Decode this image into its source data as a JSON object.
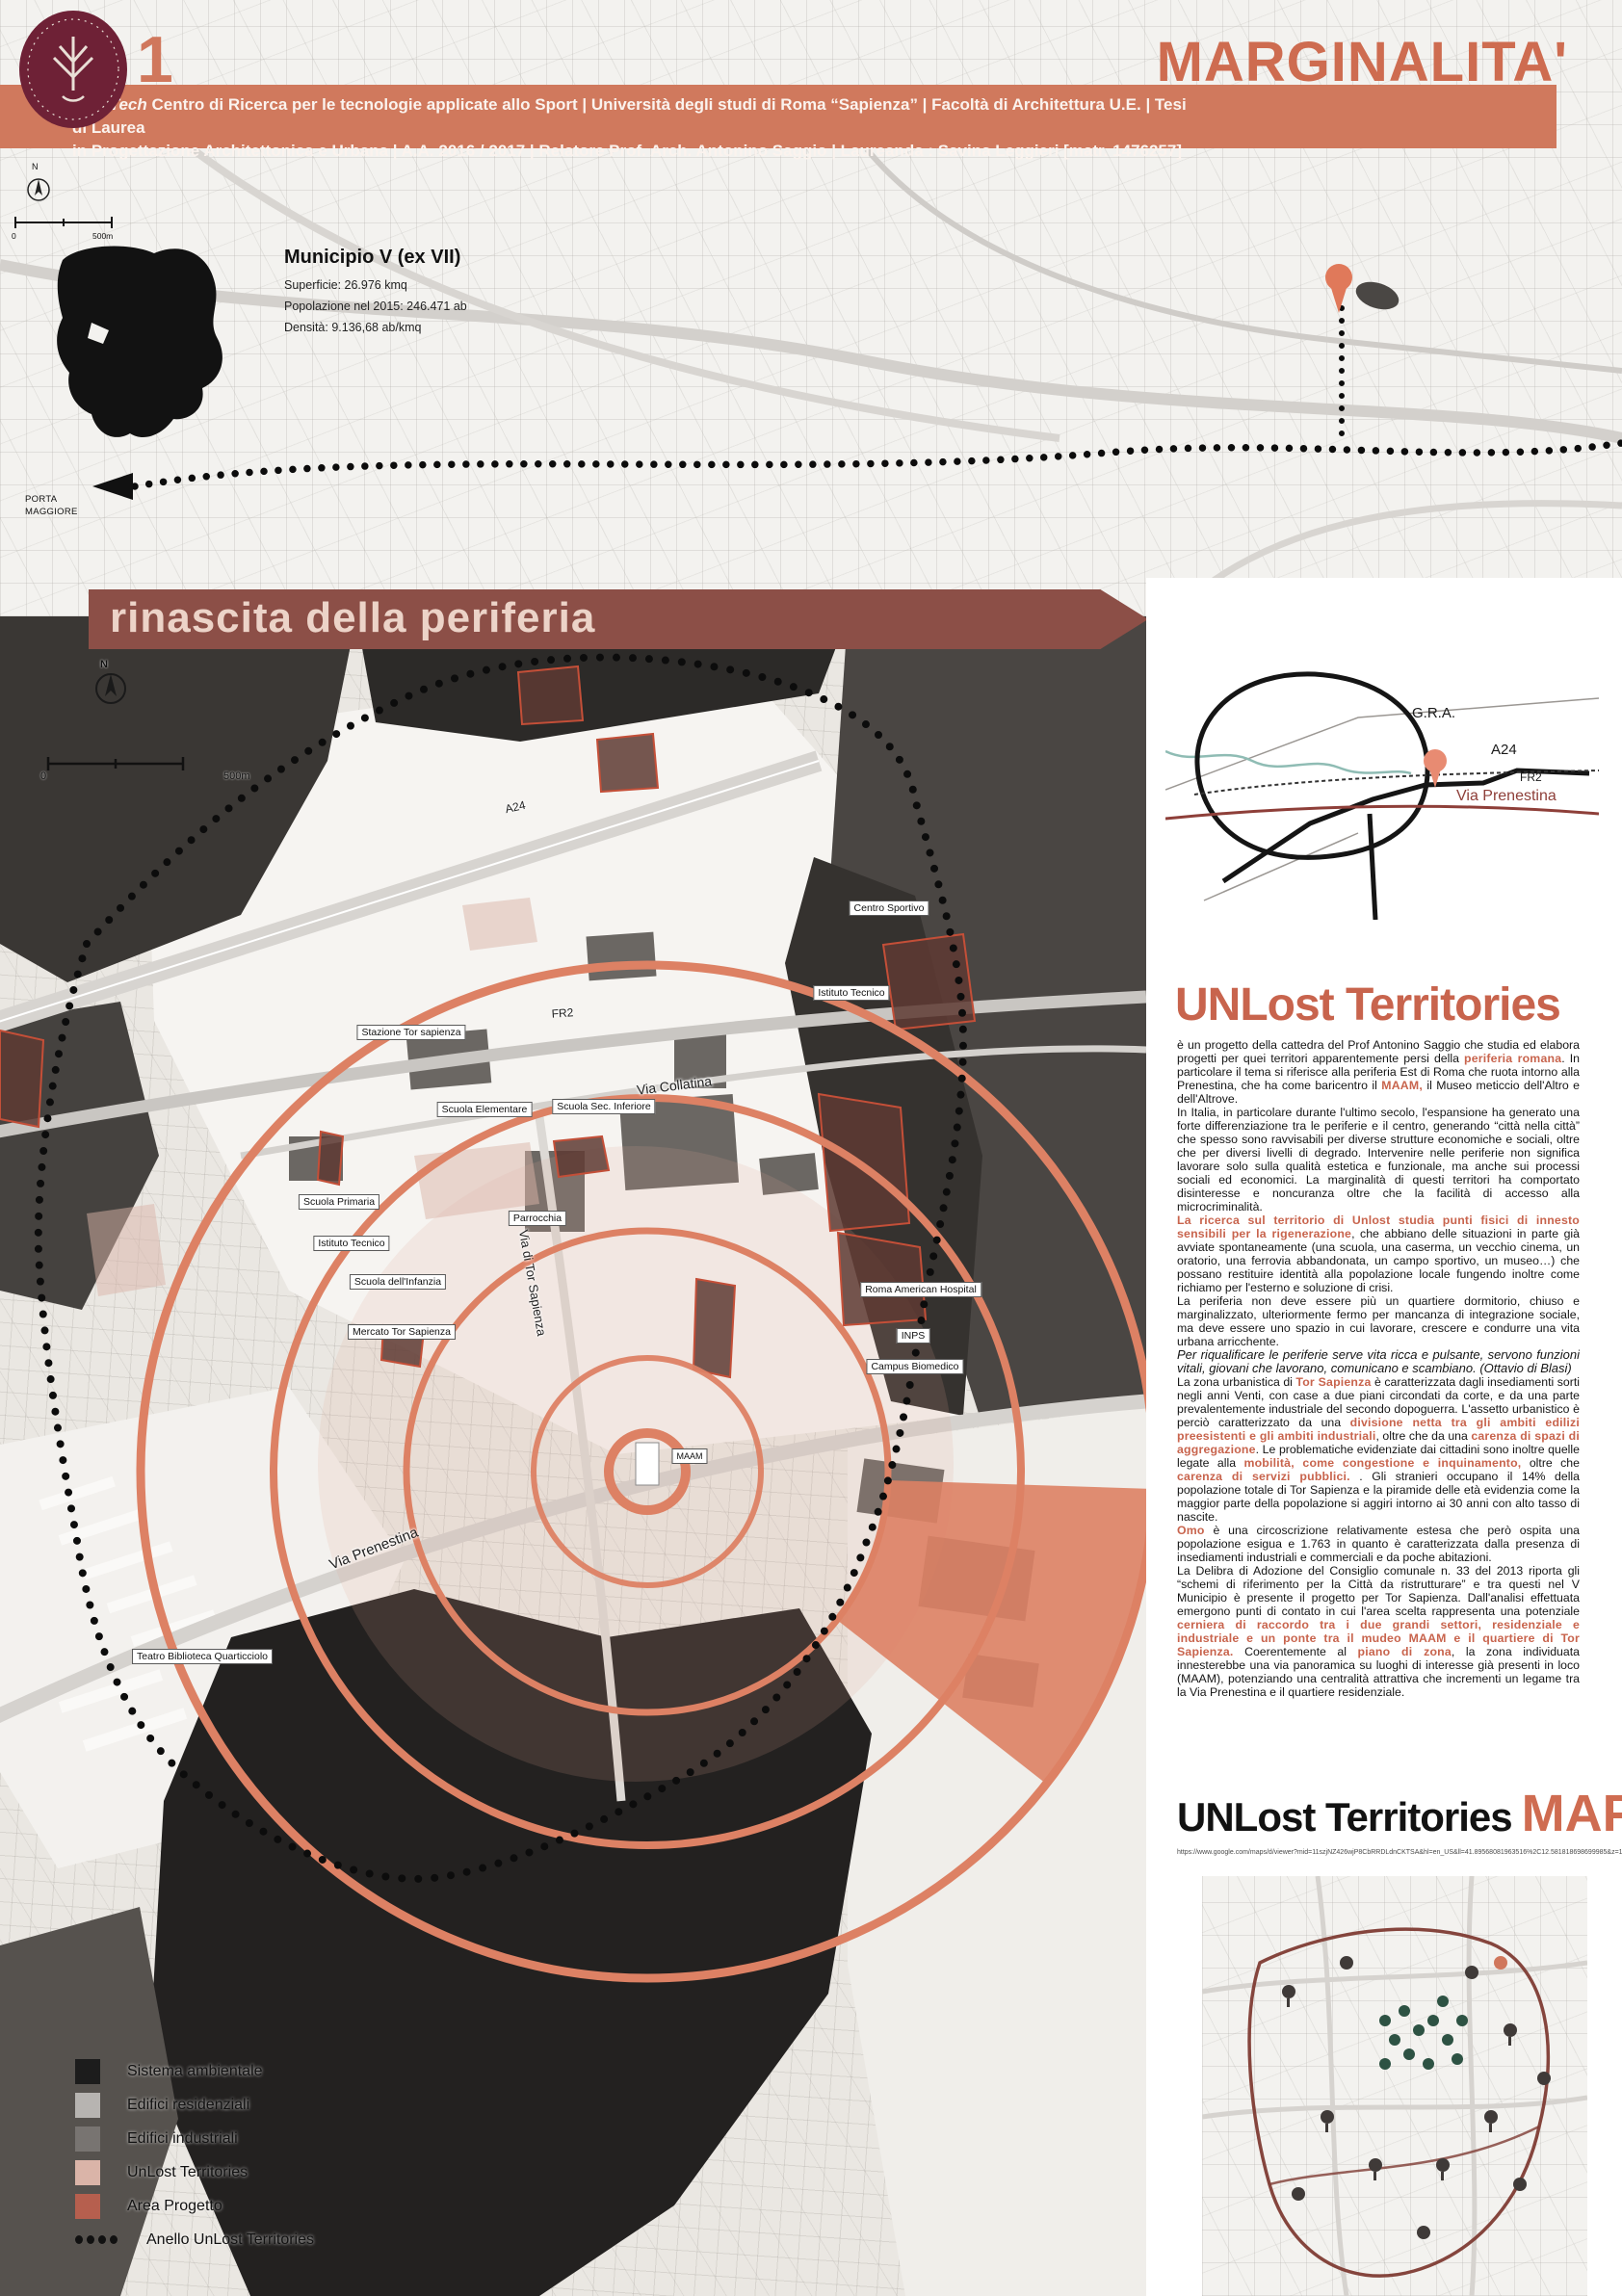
{
  "header": {
    "page_number": "1",
    "logo_name": "sapienza-university-emblem",
    "title": "MARGINALITA'",
    "subtitle_brand": "SporTech",
    "subtitle_line1_rest": " Centro di Ricerca per le tecnologie applicate allo Sport | Università degli studi di Roma “Sapienza” | Facoltà di Architettura U.E. | Tesi di Laurea",
    "subtitle_line2": "in Progettazione Architettonica e Urbana | A.A. 2016 / 2017 | Relatore Prof. Arch. Antonino Saggio | Laureanda : Savina Leggieri [matr. 1476257]"
  },
  "upper_map": {
    "municipio": {
      "title": "Municipio V (ex VII)",
      "stat1": "Superficie: 26.976 kmq",
      "stat2": "Popolazione nel 2015: 246.471 ab",
      "stat3": "Densità: 9.136,68 ab/kmq"
    },
    "porta_maggiore": "PORTA MAGGIORE",
    "north": "N",
    "scale_zero": "0",
    "scale_label": "500m"
  },
  "banner": {
    "text": "rinascita della periferia"
  },
  "main_map": {
    "north": "N",
    "scale_zero": "0",
    "scale_label": "500m",
    "labels_boxed": [
      "Centro Sportivo",
      "Istituto Tecnico",
      "Stazione Tor sapienza",
      "Scuola Elementare",
      "Scuola Sec. Inferiore",
      "Scuola Primaria",
      "Parrocchia",
      "Istituto Tecnico",
      "Scuola dell'Infanzia",
      "Mercato Tor Sapienza",
      "Roma American Hospital",
      "INPS",
      "Campus Biomedico",
      "MAAM",
      "Teatro Biblioteca Quarticciolo"
    ],
    "labels_road": [
      "A24",
      "FR2",
      "Via Collatina",
      "Via di Tor Sapienza",
      "Via Prenestina"
    ]
  },
  "gra_diagram": {
    "labels": {
      "gra": "G.R.A.",
      "a24": "A24",
      "fr2": "FR2",
      "prenestina": "Via Prenestina"
    }
  },
  "article": {
    "title": "UNLost Territories",
    "paragraphs": [
      {
        "segments": [
          {
            "t": "è un progetto della cattedra del Prof Antonino Saggio che studia ed elabora progetti per quei territori apparentemente persi della ",
            "s": "n"
          },
          {
            "t": "periferia romana",
            "s": "a"
          },
          {
            "t": ". In particolare il tema si riferisce alla periferia Est di Roma che ruota intorno alla Prenestina, che ha come baricentro il ",
            "s": "n"
          },
          {
            "t": "MAAM,",
            "s": "a"
          },
          {
            "t": " il Museo meticcio dell'Altro e dell'Altrove.",
            "s": "n"
          }
        ]
      },
      {
        "segments": [
          {
            "t": "In Italia, in particolare durante l'ultimo secolo, l'espansione ha generato una forte differenziazione tra le periferie e il centro, generando “città nella città” che spesso sono ravvisabili per diverse strutture economiche e sociali, oltre che per diversi livelli di degrado. Intervenire nelle periferie non significa lavorare solo sulla qualità estetica e funzionale, ma anche sui processi sociali ed economici. La marginalità di questi territori ha comportato disinteresse e noncuranza oltre che la facilità di accesso alla microcriminalità.",
            "s": "n"
          }
        ]
      },
      {
        "segments": [
          {
            "t": "La ricerca sul territorio di Unlost studia punti fisici di innesto sensibili per la rigenerazione",
            "s": "a"
          },
          {
            "t": ", che abbiano delle situazioni in parte già avviate spontaneamente (una scuola, una caserma, un vecchio cinema, un oratorio, una ferrovia abbandonata, un campo sportivo, un museo…) che possano restituire identità alla popolazione locale fungendo inoltre come richiamo per l'esterno e soluzione di crisi.",
            "s": "n"
          }
        ]
      },
      {
        "segments": [
          {
            "t": "La periferia non deve essere più un quartiere dormitorio, chiuso e marginalizzato, ulteriormente fermo per mancanza di integrazione sociale, ma deve essere uno spazio in cui lavorare, crescere e condurre una vita urbana arricchente.",
            "s": "n"
          }
        ]
      },
      {
        "segments": [
          {
            "t": "Per riqualificare le periferie serve vita ricca e pulsante, servono funzioni vitali, giovani che lavorano, comunicano e scambiano. (Ottavio di Blasi)",
            "s": "i"
          }
        ]
      },
      {
        "segments": [
          {
            "t": "La zona urbanistica di ",
            "s": "n"
          },
          {
            "t": "Tor Sapienza",
            "s": "a"
          },
          {
            "t": " è caratterizzata dagli insediamenti sorti negli anni Venti, con case a due piani circondati da corte, e da una parte prevalentemente industriale del secondo dopoguerra. L'assetto urbanistico è perciò caratterizzato da una ",
            "s": "n"
          },
          {
            "t": "divisione netta tra gli ambiti edilizi preesistenti e gli ambiti industriali",
            "s": "a"
          },
          {
            "t": ", oltre che da una ",
            "s": "n"
          },
          {
            "t": "carenza di spazi di aggregazione",
            "s": "a"
          },
          {
            "t": ". Le problematiche evidenziate dai cittadini sono inoltre quelle legate alla ",
            "s": "n"
          },
          {
            "t": "mobilità, come congestione e inquinamento,",
            "s": "a"
          },
          {
            "t": " oltre che ",
            "s": "n"
          },
          {
            "t": "carenza di servizi pubblici.",
            "s": "a"
          },
          {
            "t": " . Gli stranieri occupano il 14% della popolazione totale di Tor Sapienza e la piramide delle età evidenzia come la maggior parte della popolazione si aggiri intorno ai 30 anni con alto tasso di nascite.",
            "s": "n"
          }
        ]
      },
      {
        "segments": [
          {
            "t": "Omo",
            "s": "a"
          },
          {
            "t": " è una circoscrizione relativamente estesa che però ospita una popolazione esigua e 1.763 in quanto è caratterizzata dalla presenza di insediamenti industriali e commerciali e da poche abitazioni.",
            "s": "n"
          }
        ]
      },
      {
        "segments": [
          {
            "t": "La Delibra di Adozione del Consiglio comunale n. 33 del 2013 riporta gli “schemi di riferimento per la Città da ristrutturare” e tra questi nel V Municipio è presente il progetto per Tor Sapienza. Dall'analisi effettuata emergono punti di contato in cui l'area scelta rappresenta una potenziale ",
            "s": "n"
          },
          {
            "t": "cerniera di raccordo tra i due grandi settori, residenziale e industriale e un ponte tra il mudeo MAAM e il quartiere di Tor Sapienza.",
            "s": "a"
          },
          {
            "t": " Coerentemente al ",
            "s": "n"
          },
          {
            "t": "piano di zona",
            "s": "a"
          },
          {
            "t": ", la zona individuata innesterebbe una via panoramica su luoghi di interesse già presenti in loco (MAAM), potenziando una centralità attrattiva che incrementi un legame tra la Via Prenestina e il quartiere residenziale.",
            "s": "n"
          }
        ]
      }
    ]
  },
  "map_section": {
    "title_black": "UNLost Territories",
    "title_accent": "MAP",
    "url": "https://www.google.com/maps/d/viewer?mid=11szjNZ426wjP8CbRRDLdnCKTSA&hl=en_US&ll=41.89568081963516%2C12.581818698699985&z=14"
  },
  "legend": {
    "items": [
      {
        "label": "Sistema ambientale",
        "color": "#1c1c1c"
      },
      {
        "label": "Edifici residenziali",
        "color": "#b7b4b1"
      },
      {
        "label": "Edifici industriali",
        "color": "#787471"
      },
      {
        "label": "UnLost Territories",
        "color": "#dab4a8"
      },
      {
        "label": "Area Progetto",
        "color": "#b65f4e"
      },
      {
        "label": "Anello UnLost Territories",
        "color": "#111111"
      }
    ]
  },
  "colors": {
    "accent_orange": "#d0775c",
    "title_orange": "#ce6c50",
    "heading_orange": "#c8644d",
    "banner_maroon": "#8c4f47",
    "banner_text": "#ecd3c8",
    "ring_salmon": "#dd8164",
    "prenestina_red": "#8e3f39"
  }
}
